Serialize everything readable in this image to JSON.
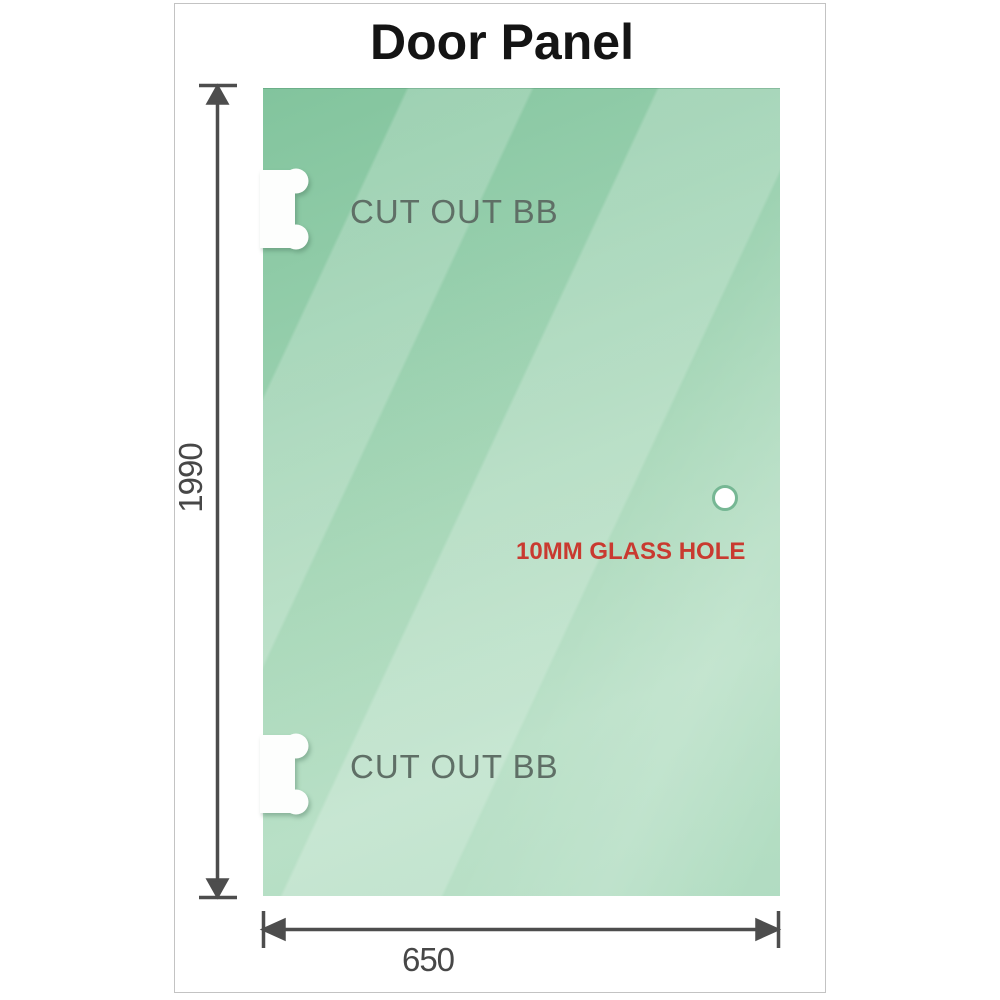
{
  "title": "Door Panel",
  "panel": {
    "cutouts": [
      {
        "label": "CUT OUT BB"
      },
      {
        "label": "CUT OUT BB"
      }
    ],
    "hole": {
      "label": "10MM GLASS HOLE"
    }
  },
  "dimensions": {
    "height": {
      "label": "1990"
    },
    "width": {
      "label": "650"
    }
  },
  "colors": {
    "glass_green_dark": "#82c49d",
    "glass_green_light": "#b7dfc5",
    "dimension_line": "#4d4d4d",
    "cutout_label": "#5f6f66",
    "hole_label_red": "#c93a30",
    "frame_border": "#c3c3c3",
    "hole_ring": "#76b794"
  }
}
